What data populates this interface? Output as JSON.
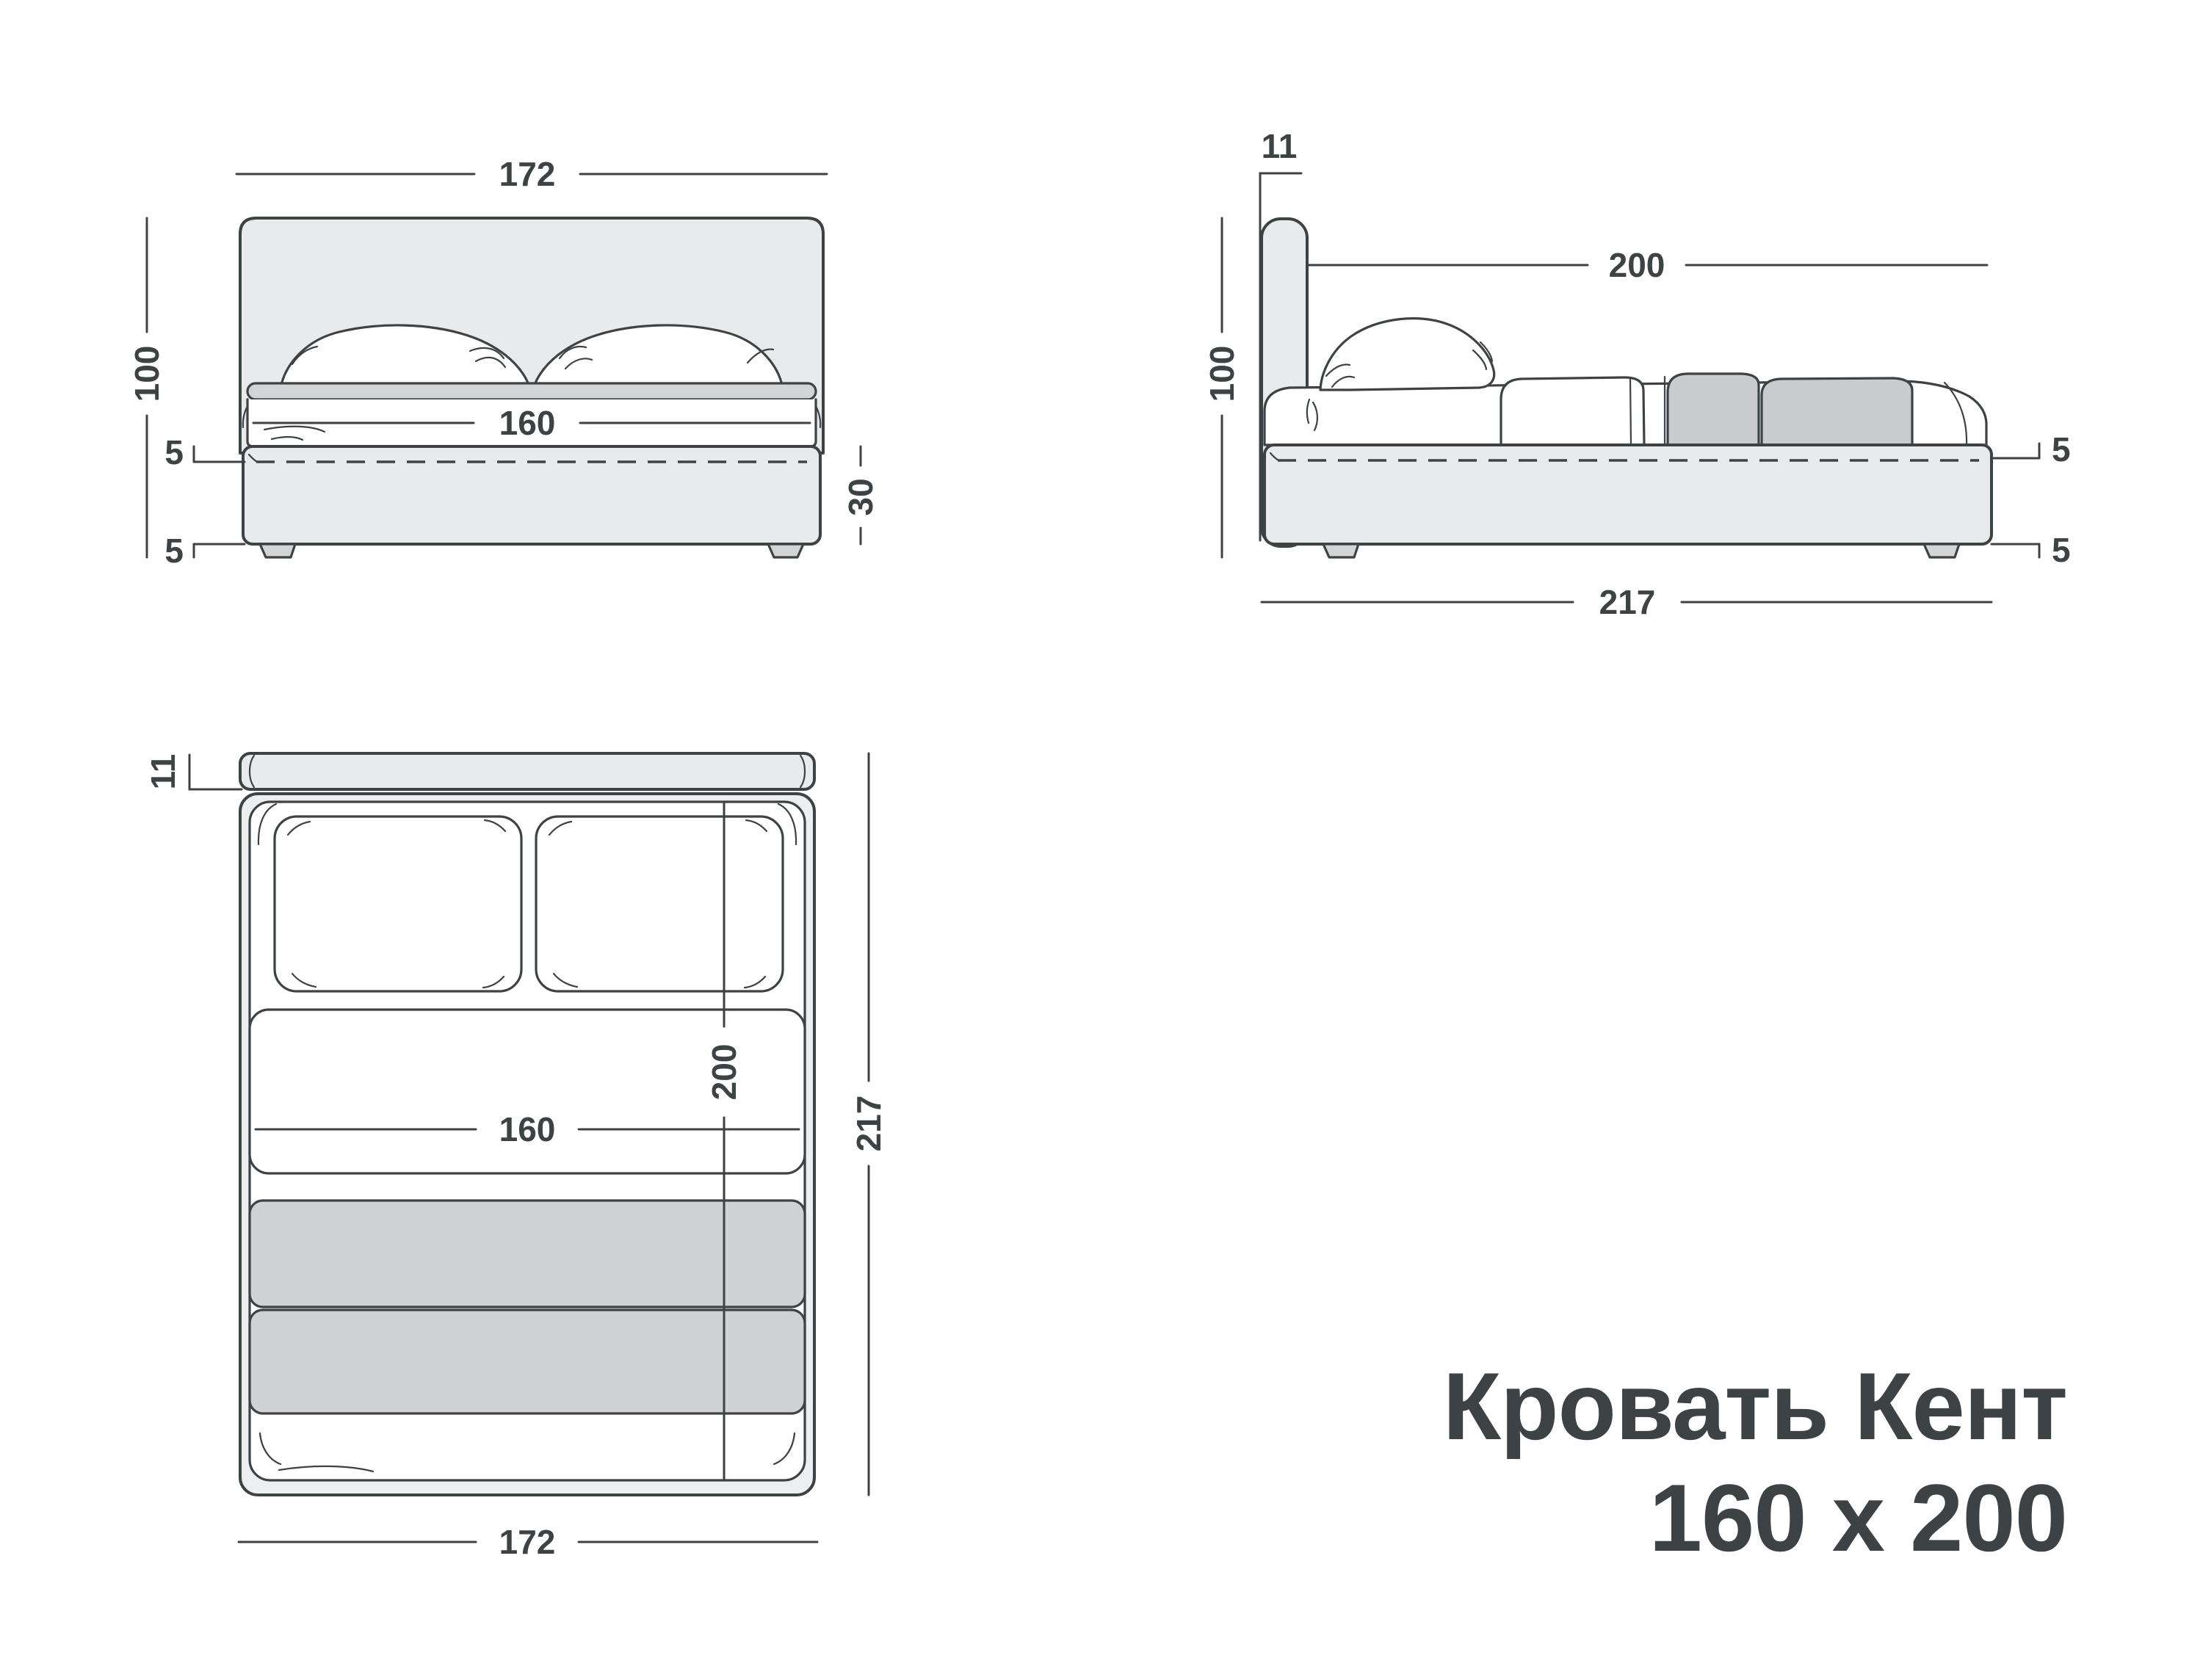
{
  "title": {
    "line1": "Кровать Кент",
    "line2": "160 x 200"
  },
  "dims": {
    "front_width": "172",
    "front_height": "100",
    "front_mattress_width": "160",
    "front_base_height": "30",
    "front_seam_offset": "5",
    "front_leg_height": "5",
    "side_headboard_thickness": "11",
    "side_mattress_length": "200",
    "side_height": "100",
    "side_seam_offset": "5",
    "side_leg_height": "5",
    "side_total_length": "217",
    "top_headboard_thickness": "11",
    "top_mattress_width": "160",
    "top_mattress_length": "200",
    "top_total_length": "217",
    "top_total_width": "172"
  },
  "colors": {
    "ink": "#3d4245",
    "panel_grey": "#e8eaeb",
    "piping_grey": "#d2d4d6",
    "blanket_grey": "#c9cbcd",
    "band_grey": "#cfd1d3",
    "background": "#ffffff"
  }
}
